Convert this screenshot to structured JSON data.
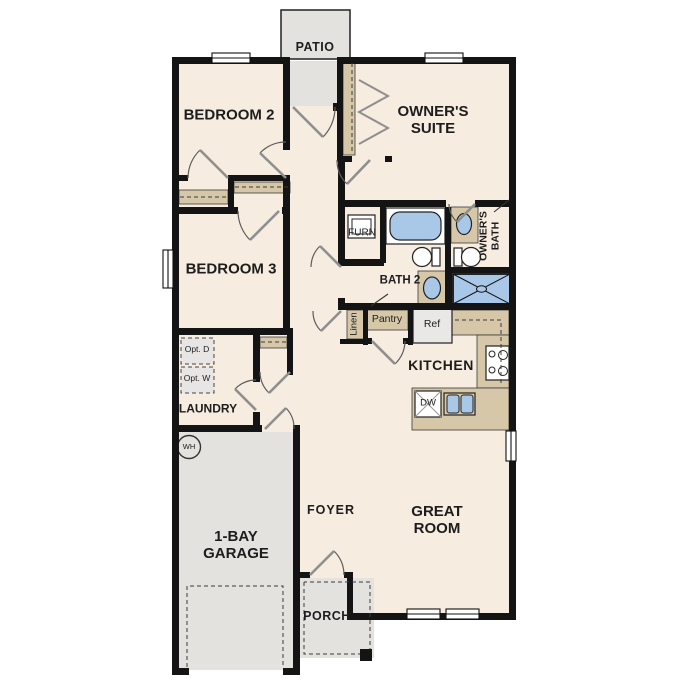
{
  "title": "Single-story house floor plan",
  "labels": {
    "patio": "PATIO",
    "bedroom2": "BEDROOM 2",
    "owners_suite": "OWNER'S SUITE",
    "owners_bath": "OWNER'S BATH",
    "bedroom3": "BEDROOM 3",
    "furn": "FURN",
    "bath2": "BATH 2",
    "linen": "Linen",
    "pantry": "Pantry",
    "ref": "Ref",
    "kitchen": "KITCHEN",
    "opt_d": "Opt. D",
    "opt_w": "Opt. W",
    "laundry": "LAUNDRY",
    "wh": "WH",
    "garage": "1-BAY GARAGE",
    "foyer": "FOYER",
    "great_room": "GREAT ROOM",
    "dw": "DW",
    "porch": "PORCH"
  },
  "colors": {
    "floor_cream": "#f6ecdf",
    "concrete_gray": "#e3e2df",
    "counter_tan": "#d5c7a8",
    "fixture_blue": "#a9c7e7",
    "wall_black": "#141414",
    "text": "#1d1d1d",
    "appliance_gray": "#e9e8e6"
  }
}
